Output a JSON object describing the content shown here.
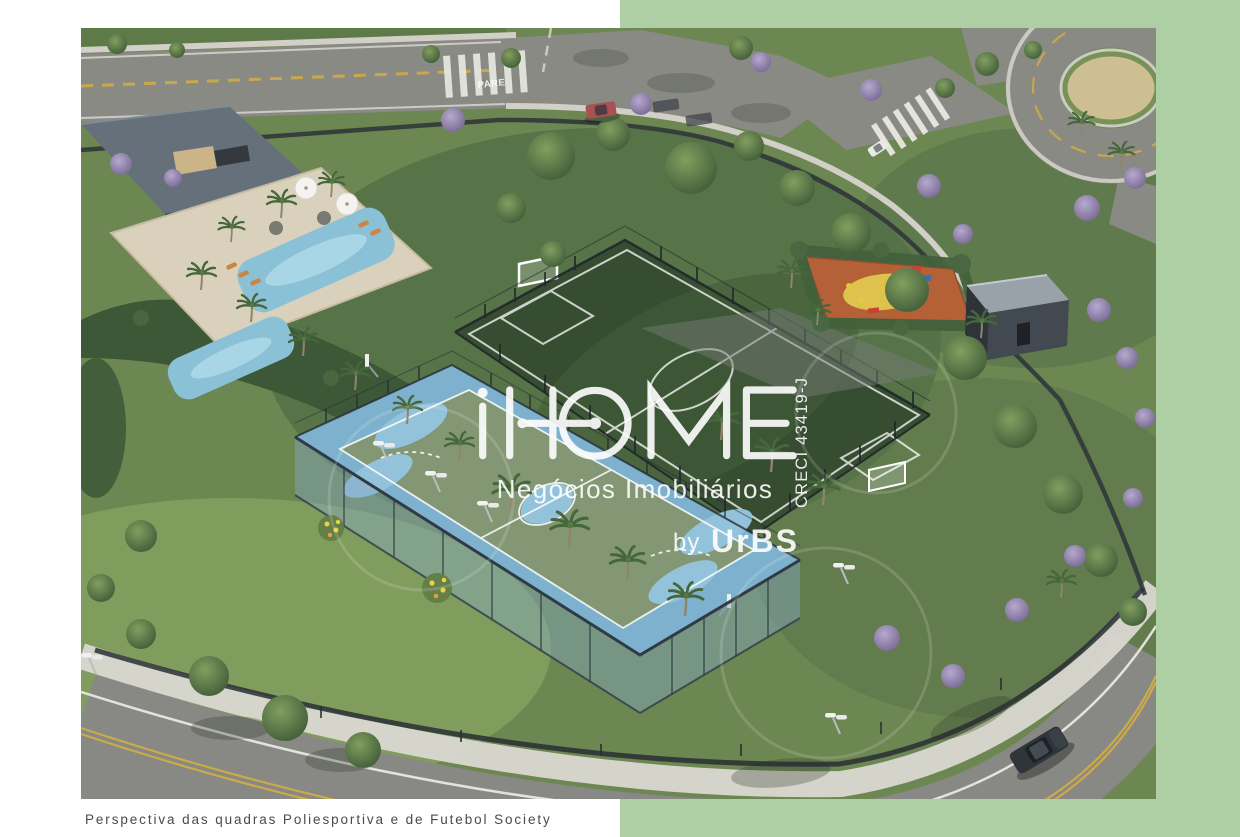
{
  "backdrop": {
    "color": "#aecfa3"
  },
  "watermark": {
    "brand": "iHOME",
    "subtitle": "Negócios Imobiliários",
    "by_label": "by",
    "by_brand": "UrBS",
    "creci": "CRECI 43419-J",
    "color": "#ffffff"
  },
  "caption": {
    "text": "Perspectiva das quadras Poliesportiva e de Futebol Society",
    "color": "#4a4a4a"
  },
  "scene": {
    "road_marking": "PARE",
    "colors": {
      "backdrop_green": "#aecfa3",
      "grass": "#66824a",
      "asphalt": "#85857f",
      "sidewalk": "#d0cec6",
      "lane_yellow": "#cfa93e",
      "court_blue": "#79aecb",
      "court_green": "#7e936f",
      "court_markings": "#ffffff",
      "soccer_field_green": "#2e4629",
      "pool_water": "#86bfd6",
      "pool_deck": "#d9cfba",
      "playground_orange": "#b25a30",
      "playground_light": "#e8d94e",
      "jacaranda_purple": "#9386b1",
      "fence_dark": "#242a31",
      "clubhouse_roof": "#5f6a75",
      "watermark_white": "#ffffff"
    }
  }
}
